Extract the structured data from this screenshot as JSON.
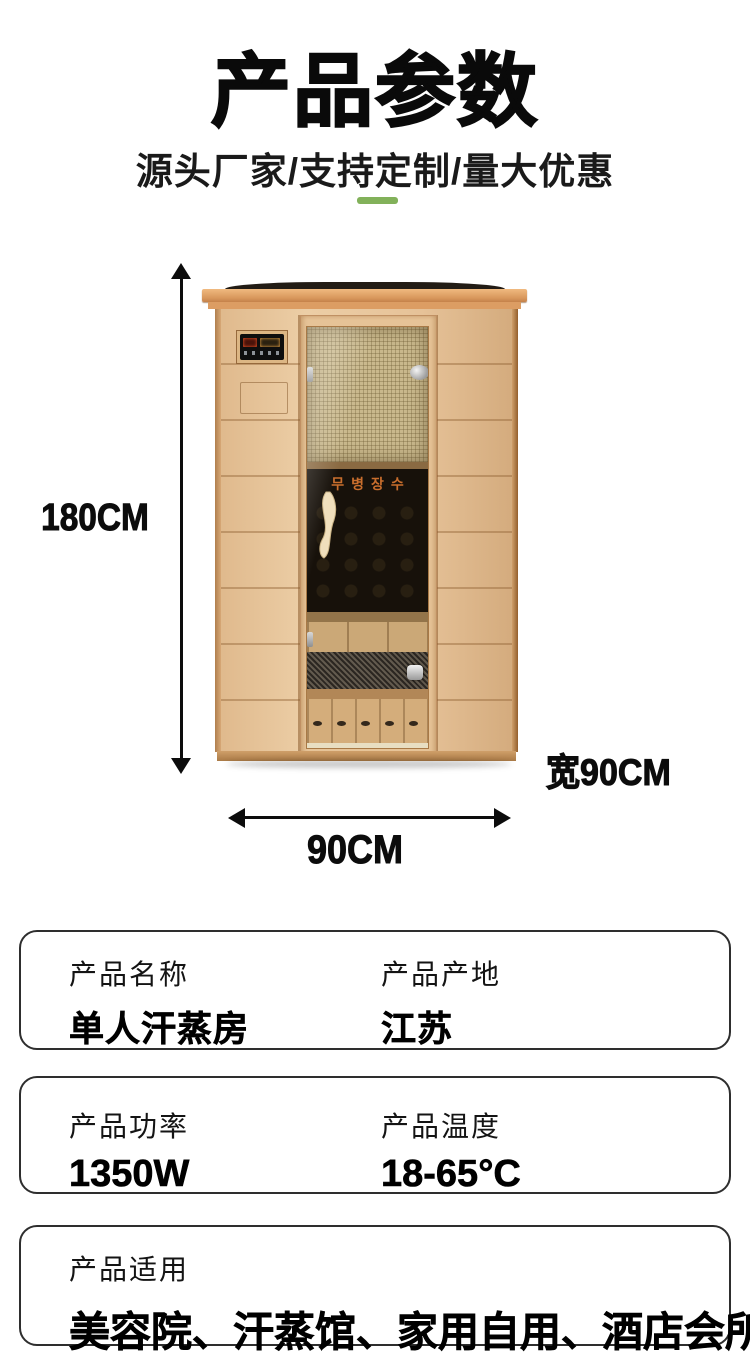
{
  "header": {
    "title": "产品参数",
    "subtitle": "源头厂家/支持定制/量大优惠"
  },
  "accent_color": "#82b15a",
  "figure": {
    "height_label": "180CM",
    "width_label": "90CM",
    "side_width_label": "宽90CM",
    "door_text": "무병장수"
  },
  "cards": [
    {
      "columns": [
        {
          "label": "产品名称",
          "value": "单人汗蒸房"
        },
        {
          "label": "产品产地",
          "value": "江苏"
        }
      ]
    },
    {
      "columns": [
        {
          "label": "产品功率",
          "value": "1350W"
        },
        {
          "label": "产品温度",
          "value": "18-65°C"
        }
      ]
    },
    {
      "columns": [
        {
          "label": "产品适用",
          "value": "美容院、汗蒸馆、家用自用、酒店会所..."
        }
      ]
    }
  ]
}
